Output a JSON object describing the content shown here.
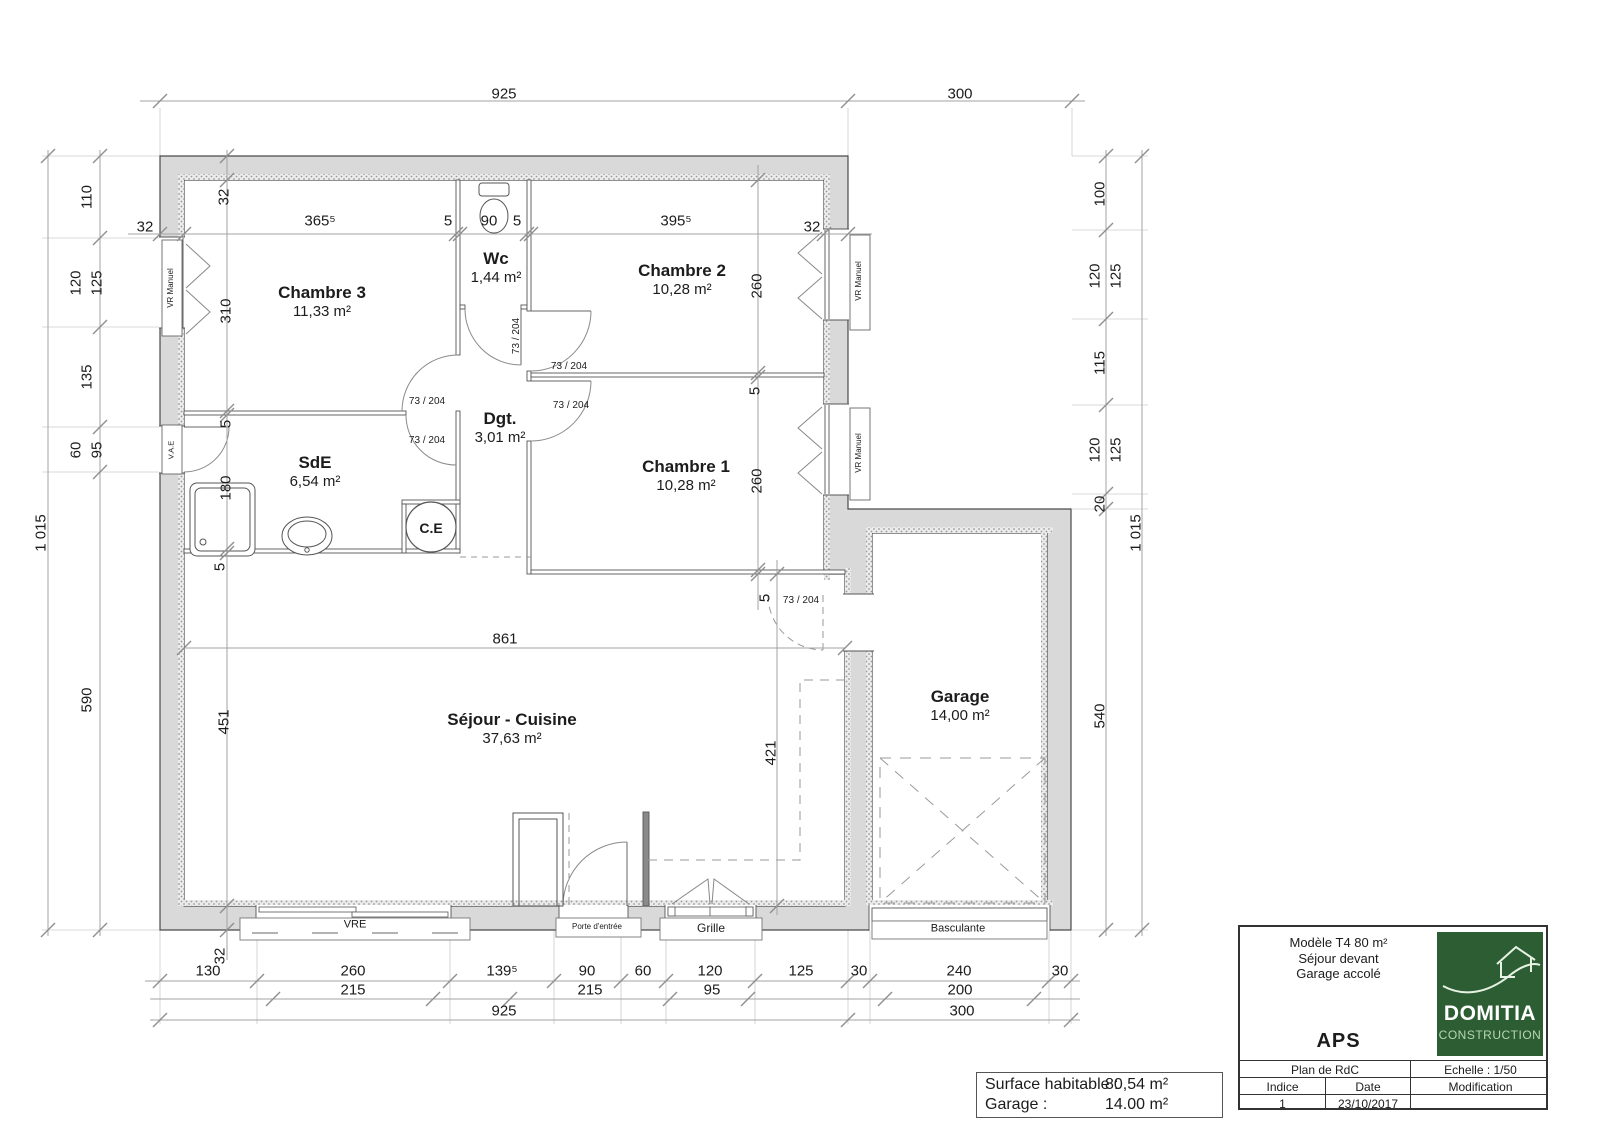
{
  "colors": {
    "logo_green": "#2d5e33",
    "wall_fill": "#d9d9d9"
  },
  "rooms": [
    {
      "name": "Chambre 3",
      "area": "11,33 m²",
      "x": 322,
      "y": 283
    },
    {
      "name": "Wc",
      "area": "1,44 m²",
      "x": 496,
      "y": 249
    },
    {
      "name": "Chambre 2",
      "area": "10,28 m²",
      "x": 682,
      "y": 261
    },
    {
      "name": "Chambre 1",
      "area": "10,28 m²",
      "x": 686,
      "y": 457
    },
    {
      "name": "SdE",
      "area": "6,54 m²",
      "x": 315,
      "y": 453
    },
    {
      "name": "Dgt.",
      "area": "3,01 m²",
      "x": 500,
      "y": 409
    },
    {
      "name": "Séjour - Cuisine",
      "area": "37,63 m²",
      "x": 512,
      "y": 710
    },
    {
      "name": "Garage",
      "area": "14,00 m²",
      "x": 960,
      "y": 687
    }
  ],
  "plan_labels": [
    {
      "n": "dim-top-main",
      "t": "925",
      "x": 504,
      "y": 94
    },
    {
      "n": "dim-top-garage",
      "t": "300",
      "x": 960,
      "y": 94
    },
    {
      "n": "dim-wall",
      "t": "32",
      "x": 145,
      "y": 227
    },
    {
      "n": "dim-ch3-w",
      "t": "365⁵",
      "x": 320,
      "y": 221
    },
    {
      "n": "dim-part",
      "t": "5",
      "x": 448,
      "y": 221
    },
    {
      "n": "dim-wc-w",
      "t": "90",
      "x": 489,
      "y": 221
    },
    {
      "n": "dim-part",
      "t": "5",
      "x": 517,
      "y": 221
    },
    {
      "n": "dim-ch2-w",
      "t": "395⁵",
      "x": 676,
      "y": 221
    },
    {
      "n": "dim-wall",
      "t": "32",
      "x": 812,
      "y": 227
    },
    {
      "n": "dim-wall",
      "t": "32",
      "x": 224,
      "y": 197,
      "r": 1
    },
    {
      "n": "dim-ch3-h",
      "t": "310",
      "x": 226,
      "y": 311,
      "r": 1
    },
    {
      "n": "dim-part",
      "t": "5",
      "x": 226,
      "y": 424,
      "r": 1
    },
    {
      "n": "dim-sde-h",
      "t": "180",
      "x": 226,
      "y": 488,
      "r": 1
    },
    {
      "n": "dim-part",
      "t": "5",
      "x": 220,
      "y": 567,
      "r": 1
    },
    {
      "n": "dim-sejour-h",
      "t": "451",
      "x": 224,
      "y": 722,
      "r": 1
    },
    {
      "n": "dim-wall",
      "t": "32",
      "x": 220,
      "y": 956,
      "r": 1
    },
    {
      "n": "dim-ch2-h",
      "t": "260",
      "x": 757,
      "y": 286,
      "r": 1
    },
    {
      "n": "dim-part",
      "t": "5",
      "x": 755,
      "y": 391,
      "r": 1
    },
    {
      "n": "dim-ch1-h",
      "t": "260",
      "x": 757,
      "y": 481,
      "r": 1
    },
    {
      "n": "dim-part",
      "t": "5",
      "x": 765,
      "y": 598,
      "r": 1
    },
    {
      "n": "dim-sejour-nook",
      "t": "421",
      "x": 771,
      "y": 753,
      "r": 1
    },
    {
      "n": "dim-sejour-w",
      "t": "861",
      "x": 505,
      "y": 639
    },
    {
      "n": "dim-left",
      "t": "110",
      "x": 87,
      "y": 197,
      "r": 1
    },
    {
      "n": "dim-left",
      "t": "120",
      "x": 76,
      "y": 283,
      "r": 1
    },
    {
      "n": "dim-left",
      "t": "125",
      "x": 97,
      "y": 283,
      "r": 1
    },
    {
      "n": "dim-left",
      "t": "135",
      "x": 87,
      "y": 377,
      "r": 1
    },
    {
      "n": "dim-left",
      "t": "60",
      "x": 76,
      "y": 450,
      "r": 1
    },
    {
      "n": "dim-left",
      "t": "95",
      "x": 97,
      "y": 450,
      "r": 1
    },
    {
      "n": "dim-left",
      "t": "590",
      "x": 87,
      "y": 700,
      "r": 1
    },
    {
      "n": "dim-left-total",
      "t": "1 015",
      "x": 41,
      "y": 533,
      "r": 1
    },
    {
      "n": "dim-right",
      "t": "100",
      "x": 1100,
      "y": 194,
      "r": 1
    },
    {
      "n": "dim-right",
      "t": "120",
      "x": 1095,
      "y": 276,
      "r": 1
    },
    {
      "n": "dim-right",
      "t": "125",
      "x": 1116,
      "y": 276,
      "r": 1
    },
    {
      "n": "dim-right",
      "t": "115",
      "x": 1100,
      "y": 363,
      "r": 1
    },
    {
      "n": "dim-right",
      "t": "120",
      "x": 1095,
      "y": 450,
      "r": 1
    },
    {
      "n": "dim-right",
      "t": "125",
      "x": 1116,
      "y": 450,
      "r": 1
    },
    {
      "n": "dim-right",
      "t": "20",
      "x": 1100,
      "y": 504,
      "r": 1
    },
    {
      "n": "dim-right",
      "t": "540",
      "x": 1100,
      "y": 716,
      "r": 1
    },
    {
      "n": "dim-right-total",
      "t": "1 015",
      "x": 1136,
      "y": 533,
      "r": 1
    },
    {
      "n": "dim-bottom",
      "t": "130",
      "x": 208,
      "y": 971
    },
    {
      "n": "dim-bottom",
      "t": "260",
      "x": 353,
      "y": 971
    },
    {
      "n": "dim-bottom",
      "t": "139⁵",
      "x": 502,
      "y": 971
    },
    {
      "n": "dim-bottom",
      "t": "90",
      "x": 587,
      "y": 971
    },
    {
      "n": "dim-bottom",
      "t": "60",
      "x": 643,
      "y": 971
    },
    {
      "n": "dim-bottom",
      "t": "120",
      "x": 710,
      "y": 971
    },
    {
      "n": "dim-bottom",
      "t": "125",
      "x": 801,
      "y": 971
    },
    {
      "n": "dim-bottom",
      "t": "30",
      "x": 859,
      "y": 971
    },
    {
      "n": "dim-bottom",
      "t": "240",
      "x": 959,
      "y": 971
    },
    {
      "n": "dim-bottom",
      "t": "30",
      "x": 1060,
      "y": 971
    },
    {
      "n": "dim-bottom2",
      "t": "215",
      "x": 353,
      "y": 990
    },
    {
      "n": "dim-bottom2",
      "t": "215",
      "x": 590,
      "y": 990
    },
    {
      "n": "dim-bottom2",
      "t": "95",
      "x": 712,
      "y": 990
    },
    {
      "n": "dim-bottom2",
      "t": "200",
      "x": 960,
      "y": 990
    },
    {
      "n": "dim-bottom3",
      "t": "925",
      "x": 504,
      "y": 1011
    },
    {
      "n": "dim-bottom3",
      "t": "300",
      "x": 962,
      "y": 1011
    },
    {
      "n": "door-size",
      "t": "73 / 204",
      "x": 427,
      "y": 402,
      "s": 10
    },
    {
      "n": "door-size",
      "t": "73 / 204",
      "x": 427,
      "y": 441,
      "s": 10
    },
    {
      "n": "door-size",
      "t": "73 / 204",
      "x": 517,
      "y": 336,
      "r": 1,
      "s": 10
    },
    {
      "n": "door-size",
      "t": "73 / 204",
      "x": 569,
      "y": 367,
      "s": 10
    },
    {
      "n": "door-size",
      "t": "73 / 204",
      "x": 571,
      "y": 406,
      "s": 10
    },
    {
      "n": "door-size",
      "t": "73 / 204",
      "x": 801,
      "y": 601,
      "s": 10
    },
    {
      "n": "window-label",
      "t": "VR Manuel",
      "x": 171,
      "y": 288,
      "r": 1,
      "s": 8
    },
    {
      "n": "window-label",
      "t": "VR Manuel",
      "x": 859,
      "y": 281,
      "r": 1,
      "s": 8
    },
    {
      "n": "window-label",
      "t": "VR Manuel",
      "x": 859,
      "y": 453,
      "r": 1,
      "s": 8
    },
    {
      "n": "door-label",
      "t": "V.A.E",
      "x": 171,
      "y": 450,
      "r": 1,
      "s": 7.5
    },
    {
      "n": "window-label",
      "t": "VRE",
      "x": 355,
      "y": 925,
      "s": 11
    },
    {
      "n": "door-label",
      "t": "Porte d'entrée",
      "x": 597,
      "y": 927,
      "s": 8
    },
    {
      "n": "window-label",
      "t": "Grille",
      "x": 711,
      "y": 928,
      "s": 12
    },
    {
      "n": "garage-door-label",
      "t": "Basculante",
      "x": 958,
      "y": 929,
      "s": 11
    },
    {
      "n": "water-heater-label",
      "t": "C.E",
      "x": 431,
      "y": 528,
      "s": 14,
      "b": 1
    }
  ],
  "title_block": {
    "model_line1": "Modèle T4 80 m²",
    "model_line2": "Séjour devant",
    "model_line3": "Garage accolé",
    "doc_type": "APS",
    "logo_title": "DOMITIA",
    "logo_subtitle": "CONSTRUCTION",
    "plan_label": "Plan de RdC",
    "scale_label": "Echelle : 1/50",
    "col_indice": "Indice",
    "col_date": "Date",
    "col_modification": "Modification",
    "indice_value": "1",
    "date_value": "23/10/2017",
    "modification_value": ""
  },
  "surface_table": {
    "row1_label": "Surface habitable :",
    "row1_value": "80,54 m²",
    "row2_label": "Garage :",
    "row2_value": "14.00 m²"
  }
}
